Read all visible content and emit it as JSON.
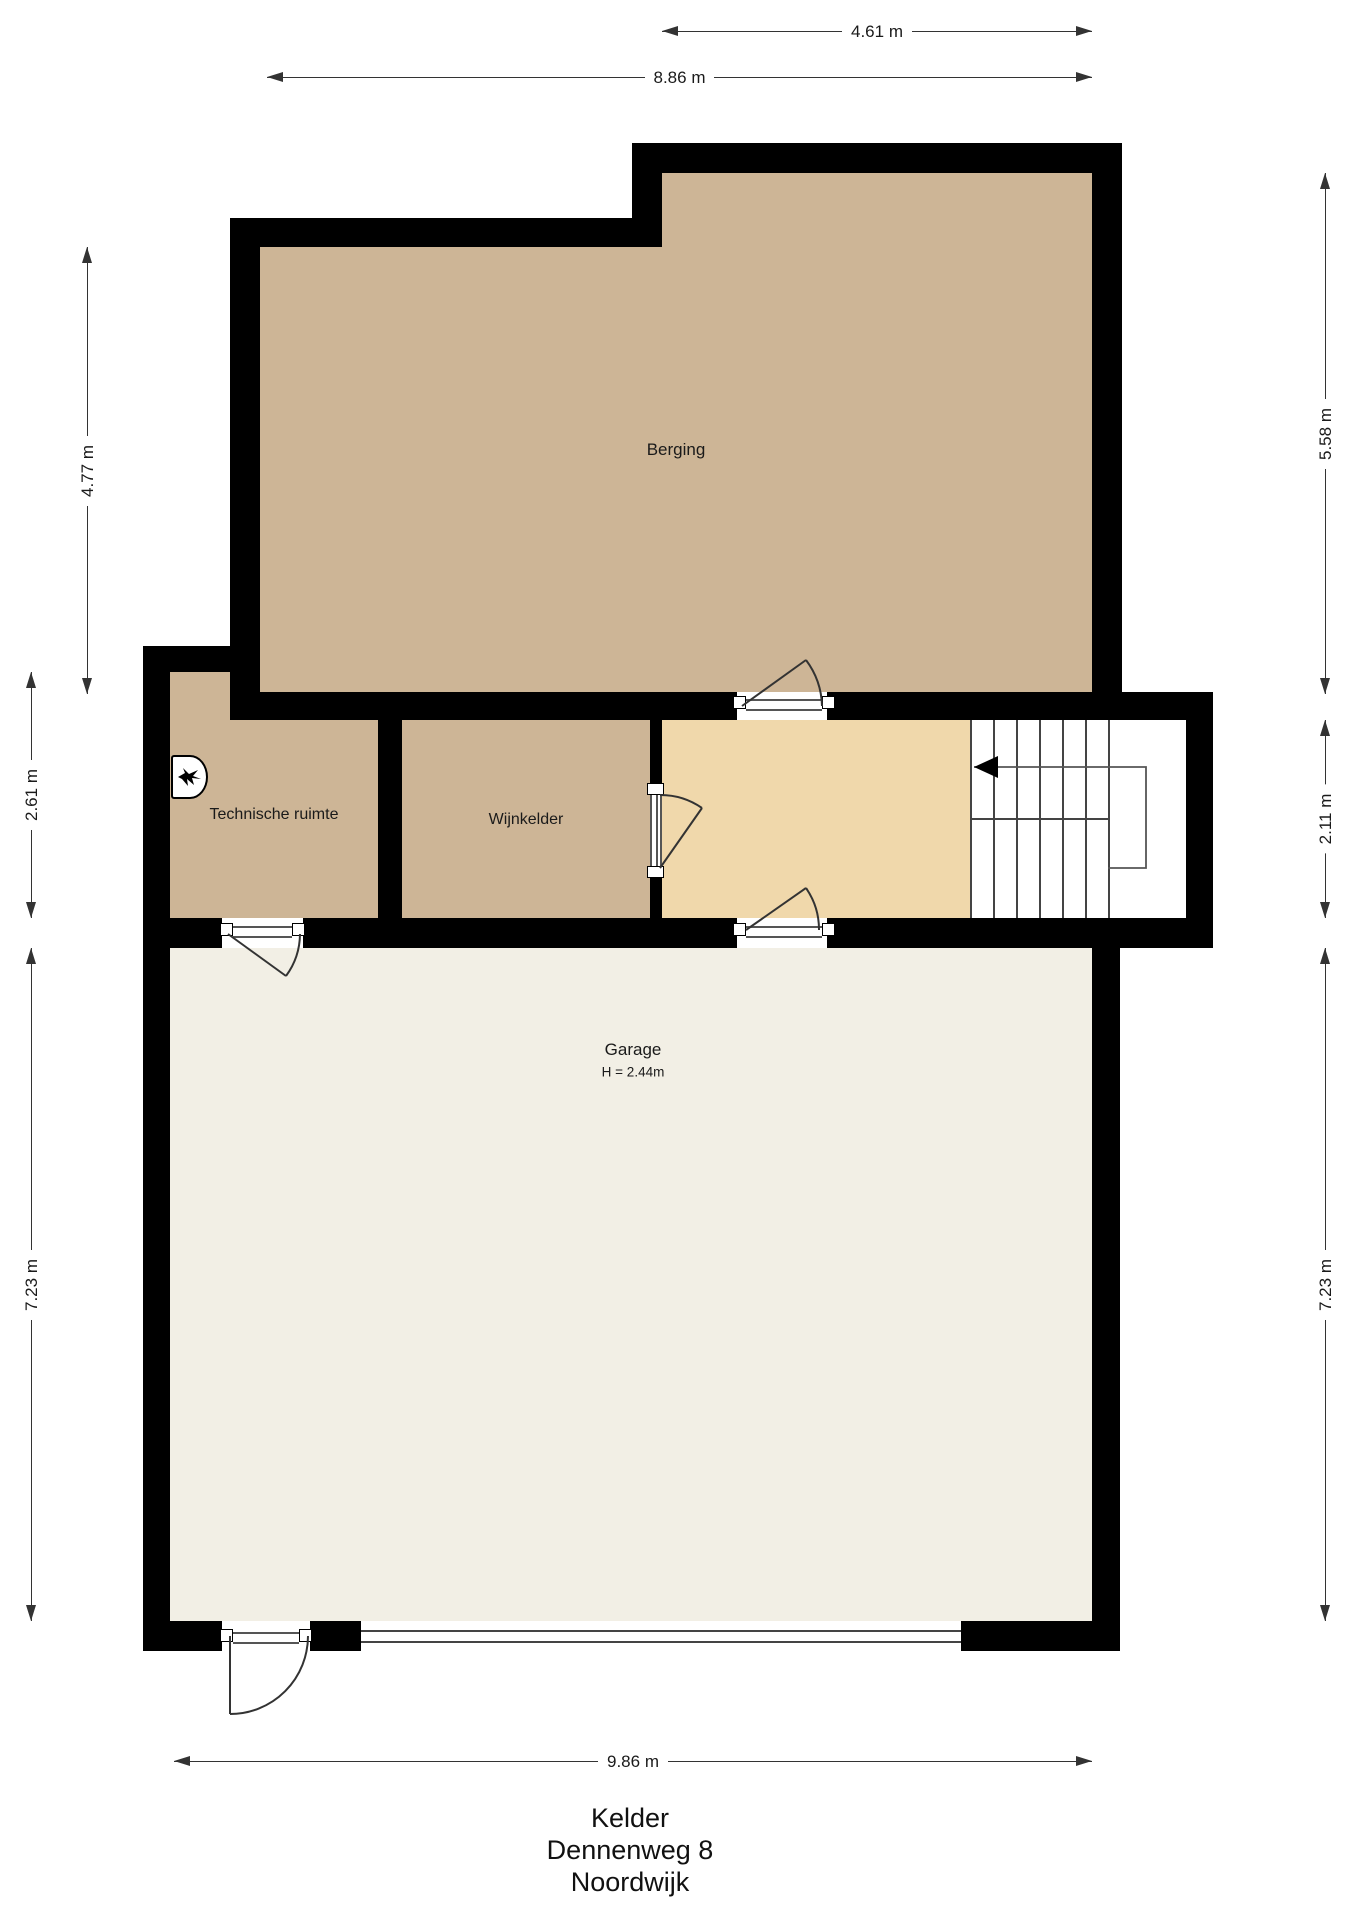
{
  "plan": {
    "type": "floor-plan",
    "floor": "Kelder"
  },
  "rooms": {
    "berging": {
      "name": "Berging"
    },
    "technische_ruimte": {
      "name": "Technische ruimte"
    },
    "wijnkelder": {
      "name": "Wijnkelder"
    },
    "garage": {
      "name": "Garage",
      "height_note": "H = 2.44m"
    }
  },
  "dimensions": {
    "top_upper": "4.61 m",
    "top_lower": "8.86 m",
    "bottom": "9.86 m",
    "left_upper": "4.77 m",
    "left_middle": "2.61 m",
    "left_lower": "7.23 m",
    "right_upper": "5.58 m",
    "right_middle": "2.11 m",
    "right_lower": "7.23 m"
  },
  "title": {
    "line1": "Kelder",
    "line2": "Dennenweg 8",
    "line3": "Noordwijk"
  },
  "icons": {
    "boiler": "cv-boiler-flame-icon",
    "stair_direction": "arrow-left-icon"
  },
  "colors": {
    "room_tan": "#cdb596",
    "hall_cream": "#f0d8ab",
    "garage_floor": "#f2efe5",
    "wall": "#000000",
    "line": "#333333",
    "text": "#1a1a1a"
  }
}
